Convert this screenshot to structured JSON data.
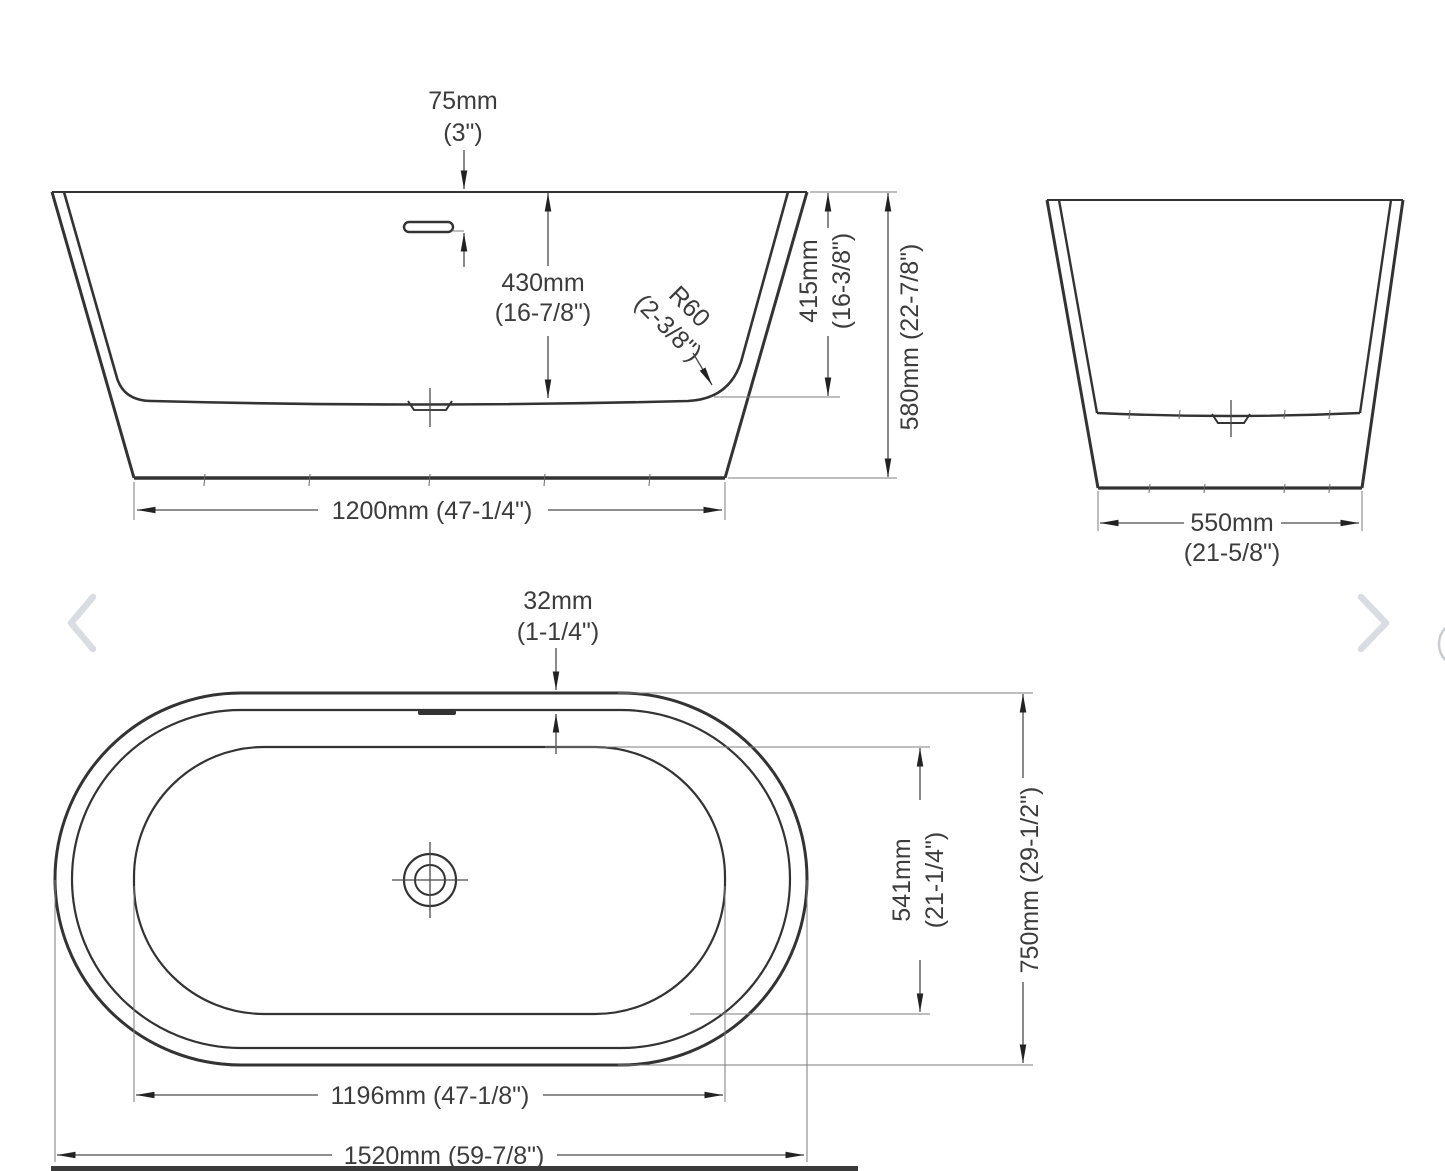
{
  "drawing": {
    "title": "Freestanding oval bathtub dimension drawing",
    "side_view": {
      "name": "side-elevation",
      "overflow_height_mm": "75mm",
      "overflow_height_in": "(3\")",
      "inner_depth_mm": "430mm",
      "inner_depth_in": "(16-7/8\")",
      "corner_radius_mm": "R60",
      "corner_radius_in": "(2-3/8\")",
      "inner_height_mm": "415mm",
      "inner_height_in": "(16-3/8\")",
      "overall_height": "580mm (22-7/8\")",
      "base_length": "1200mm (47-1/4\")"
    },
    "end_view": {
      "name": "end-elevation",
      "base_width_mm": "550mm",
      "base_width_in": "(21-5/8\")"
    },
    "top_view": {
      "name": "plan-view",
      "rim_width_mm": "32mm",
      "rim_width_in": "(1-1/4\")",
      "inner_width_mm": "541mm",
      "inner_width_in": "(21-1/4\")",
      "overall_width": "750mm (29-1/2\")",
      "inner_length": "1196mm (47-1/8\")",
      "overall_length": "1520mm (59-7/8\")"
    }
  },
  "carousel": {
    "prev_icon": "chevron-left",
    "next_icon": "chevron-right"
  },
  "colors": {
    "line": "#333333",
    "dimension": "#4a4a4a",
    "text": "#3c3c3c",
    "chevron": "#d9dce1",
    "bottom_band": "#3a3a3a"
  }
}
